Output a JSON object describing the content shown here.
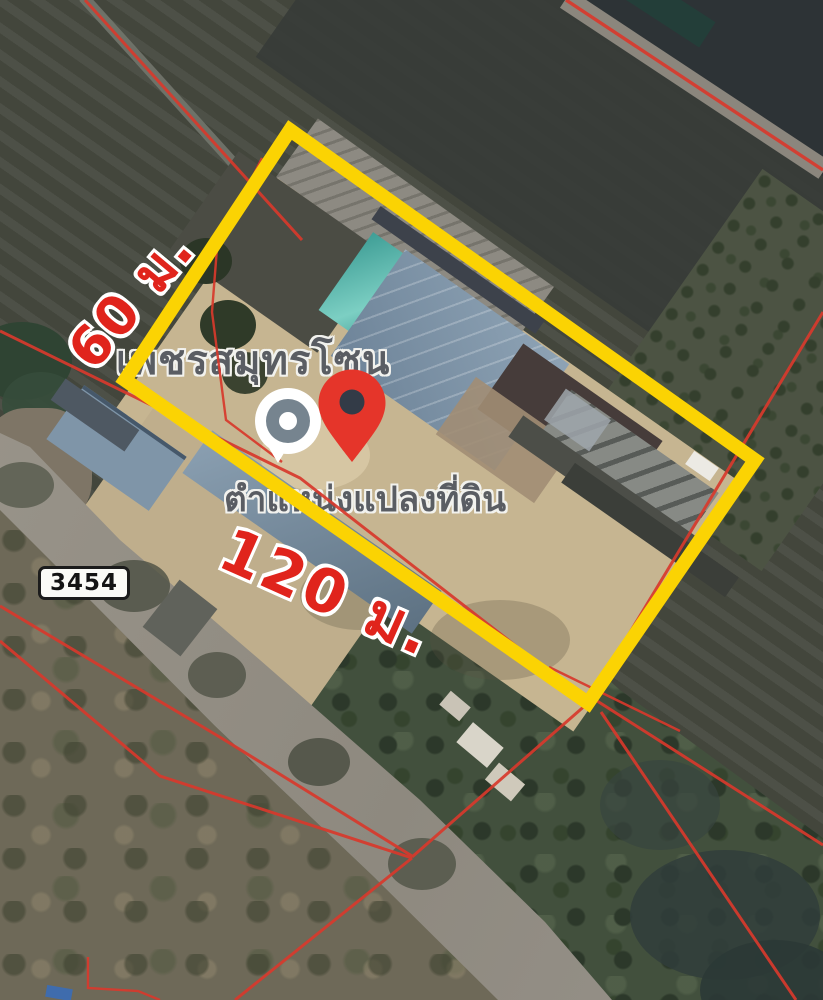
{
  "title": "Satellite map of land plot for sale with highlighted boundary",
  "labels": {
    "place_name": "เพชรสมุทรโซน",
    "plot_position": "ตำแหน่งแปลงที่ดิน",
    "road_number": "3454"
  },
  "dimensions": {
    "width_label": "120 ม.",
    "depth_label": "60 ม.",
    "width_m": 120,
    "depth_m": 60,
    "unit": "ม."
  },
  "plot": {
    "outline_color": "#fbd303",
    "outline_points": "290,130 755,460 588,703 125,380"
  },
  "overlay": {
    "parcel_line_color": "#d8392c",
    "dimension_text_color": "#e0241c",
    "label_text_color": "#5a5d63"
  },
  "markers": {
    "pin_color": "#e5352a",
    "pin_hole_color": "#333b47",
    "poi_ring_color": "#ffffff",
    "poi_disc_color": "#76848f"
  }
}
